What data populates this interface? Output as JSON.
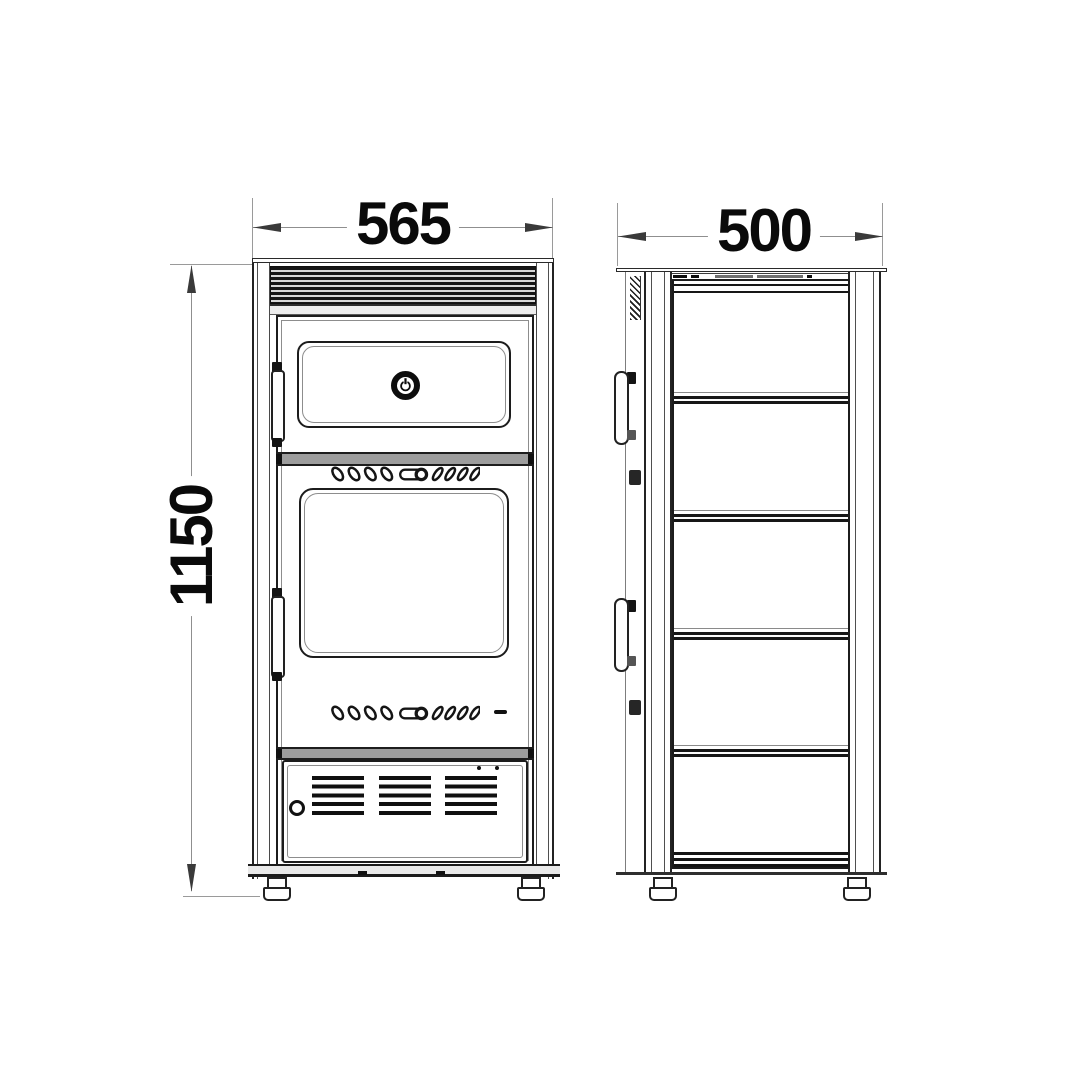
{
  "diagram": {
    "background": "#ffffff",
    "line_color": "#1c1c1c",
    "dimension_line_color": "#8f8f8f",
    "text_color": "#0a0a0a"
  },
  "dimensions": {
    "width": {
      "value": "565",
      "view": "front",
      "orientation": "horizontal"
    },
    "depth": {
      "value": "500",
      "view": "side",
      "orientation": "horizontal"
    },
    "height": {
      "value": "1150",
      "view": "front",
      "orientation": "vertical"
    }
  },
  "icons": {
    "power_button": "power-symbol"
  }
}
